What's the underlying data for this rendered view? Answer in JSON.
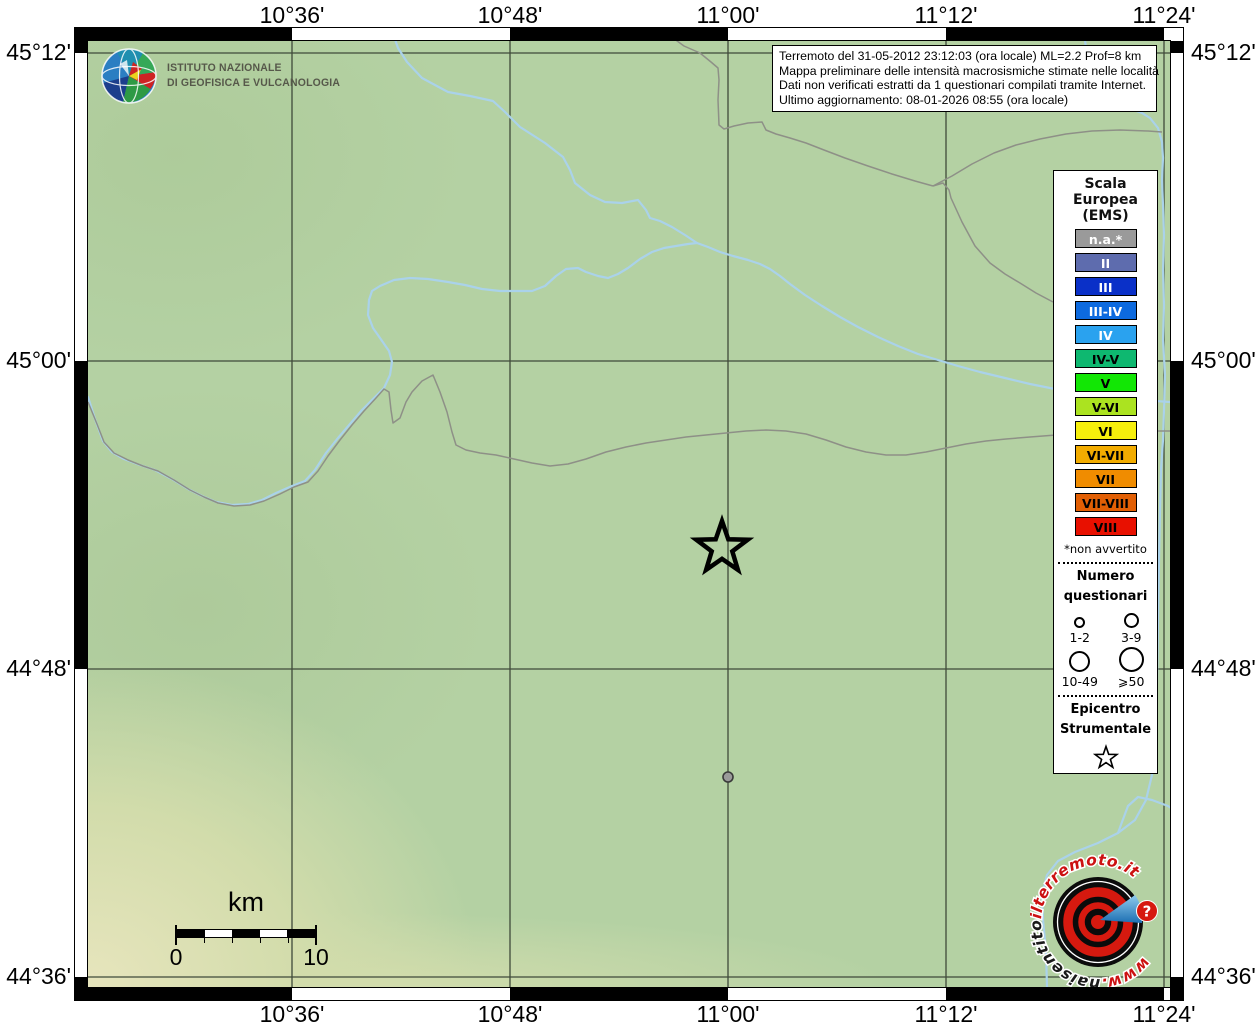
{
  "map": {
    "grid": {
      "x": [
        {
          "px": 292,
          "label": "10°36'"
        },
        {
          "px": 510,
          "label": "10°48'"
        },
        {
          "px": 728,
          "label": "11°00'"
        },
        {
          "px": 946,
          "label": "11°12'"
        },
        {
          "px": 1164,
          "label": "11°24'"
        }
      ],
      "y": [
        {
          "px": 53,
          "label": "45°12'"
        },
        {
          "px": 361,
          "label": "45°00'"
        },
        {
          "px": 669,
          "label": "44°48'"
        },
        {
          "px": 977,
          "label": "44°36'"
        }
      ]
    },
    "colors": {
      "land": "#b4d1a3",
      "river": "#aad2ea",
      "boundary": "#8e9087",
      "gridline": "#3f4a3a",
      "frame_black": "#000000",
      "frame_white": "#ffffff"
    },
    "title_box": {
      "lines": [
        "Terremoto del 31-05-2012 23:12:03 (ora locale) ML=2.2 Prof=8 km",
        "Mappa preliminare delle intensità macrosismiche stimate nelle località",
        "Dati non verificati estratti da 1 questionari compilati tramite Internet.",
        "Ultimo aggiornamento: 08-01-2026 08:55 (ora locale)"
      ]
    },
    "scale_bar": {
      "unit": "km",
      "start": "0",
      "end": "10"
    },
    "markers": {
      "epicenter": {
        "x": 722,
        "y": 548
      },
      "report_dot": {
        "x": 728,
        "y": 777,
        "color": "#9a9a9a"
      }
    }
  },
  "ingv": {
    "name_line1": "ISTITUTO NAZIONALE",
    "name_line2": "DI GEOFISICA E VULCANOLOGIA"
  },
  "legend": {
    "scale_title_lines": [
      "Scala",
      "Europea",
      "(EMS)"
    ],
    "chips": [
      {
        "label": "n.a.*",
        "color": "#9a9a9a",
        "text": "#ffffff"
      },
      {
        "label": "II",
        "color": "#5e6cae",
        "text": "#ffffff"
      },
      {
        "label": "III",
        "color": "#0a30c8",
        "text": "#ffffff"
      },
      {
        "label": "III-IV",
        "color": "#0d6adf",
        "text": "#ffffff"
      },
      {
        "label": "IV",
        "color": "#2aa2ef",
        "text": "#ffffff"
      },
      {
        "label": "IV-V",
        "color": "#0eb870",
        "text": "#000000"
      },
      {
        "label": "V",
        "color": "#12e705",
        "text": "#000000"
      },
      {
        "label": "V-VI",
        "color": "#abe320",
        "text": "#000000"
      },
      {
        "label": "VI",
        "color": "#f6ef0c",
        "text": "#000000"
      },
      {
        "label": "VI-VII",
        "color": "#f2ac00",
        "text": "#000000"
      },
      {
        "label": "VII",
        "color": "#f08c00",
        "text": "#000000"
      },
      {
        "label": "VII-VIII",
        "color": "#e25f04",
        "text": "#000000"
      },
      {
        "label": "VIII",
        "color": "#e81000",
        "text": "#000000"
      }
    ],
    "footnote": "*non avvertito",
    "questionnaires": {
      "title_lines": [
        "Numero",
        "questionari"
      ],
      "sizes": [
        {
          "label": "1-2",
          "d": 7
        },
        {
          "label": "3-9",
          "d": 11
        },
        {
          "label": "10-49",
          "d": 17
        },
        {
          "label": "⩾50",
          "d": 21
        }
      ]
    },
    "epicenter_title_lines": [
      "Epicentro",
      "Strumentale"
    ]
  },
  "watermark": {
    "www": "www.",
    "black_part": "haisentito",
    "red_part": "ilterremoto.it",
    "badge": "?"
  }
}
